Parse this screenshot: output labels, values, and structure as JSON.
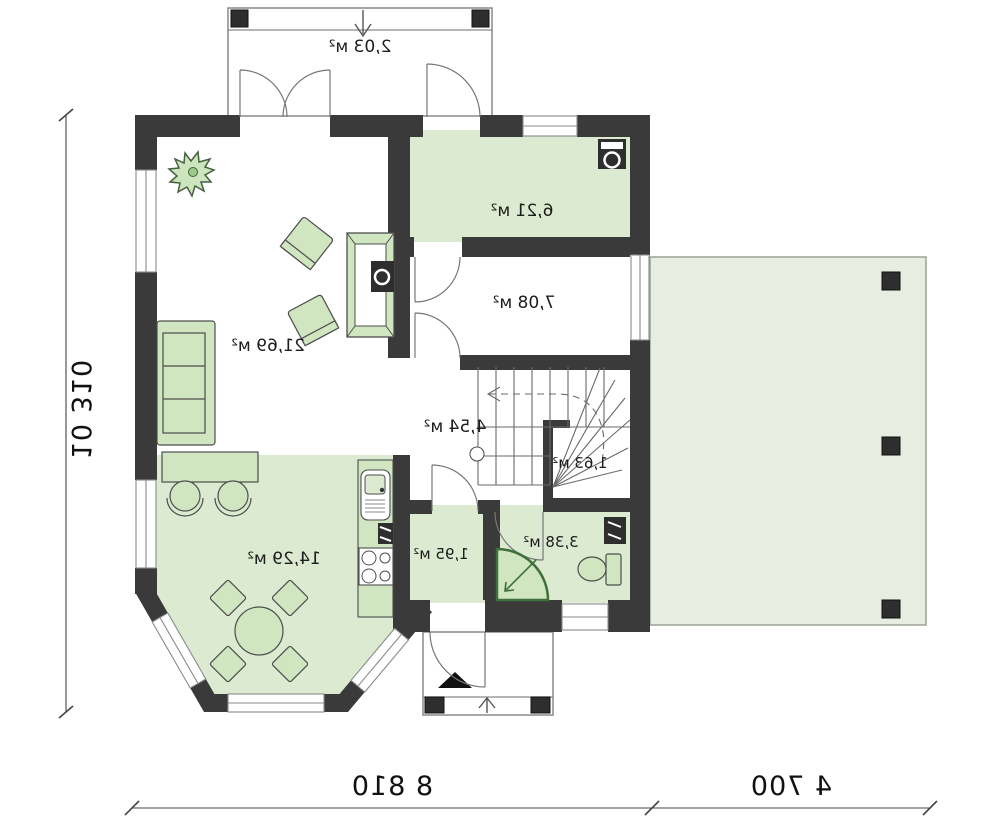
{
  "plan_type": "floor-plan (mirrored architectural drawing)",
  "rooms": [
    {
      "id": "top-terrace",
      "label": "2,03 м²"
    },
    {
      "id": "utility",
      "label": "6,21 м²"
    },
    {
      "id": "room-708",
      "label": "7,08 м²"
    },
    {
      "id": "living-room",
      "label": "21,69 м²"
    },
    {
      "id": "hall-stairs",
      "label": "4,54 м²"
    },
    {
      "id": "under-stairs",
      "label": "1,63 м²"
    },
    {
      "id": "kitchen",
      "label": "14,29 м²"
    },
    {
      "id": "vestibule",
      "label": "1,95 м²"
    },
    {
      "id": "bathroom",
      "label": "3,38 м²"
    }
  ],
  "dimensions": {
    "left_total": "10 310",
    "bottom_main": "8 810",
    "bottom_terrace": "4 700"
  },
  "colors": {
    "wall": "#3a3a3a",
    "room_fill": "#dbead0",
    "terrace_fill": "#e7ede1",
    "furniture_fill": "#cfe6c1",
    "dark_fixture": "#2e2e2e",
    "line": "#777777"
  },
  "icons": {
    "fixtures": [
      "washing-machine-icon",
      "boiler-icon",
      "sink-icon",
      "stove-icon",
      "dishwasher-icon",
      "toilet-icon",
      "shower-icon",
      "fireplace-icon",
      "plant-icon",
      "sofa-icon",
      "armchair-icon",
      "dining-table-icon",
      "bar-stool-icon",
      "pillar-icon"
    ],
    "arrows": [
      "entry-triangle-icon",
      "porch-direction-arrow",
      "stair-direction-arrow"
    ]
  }
}
